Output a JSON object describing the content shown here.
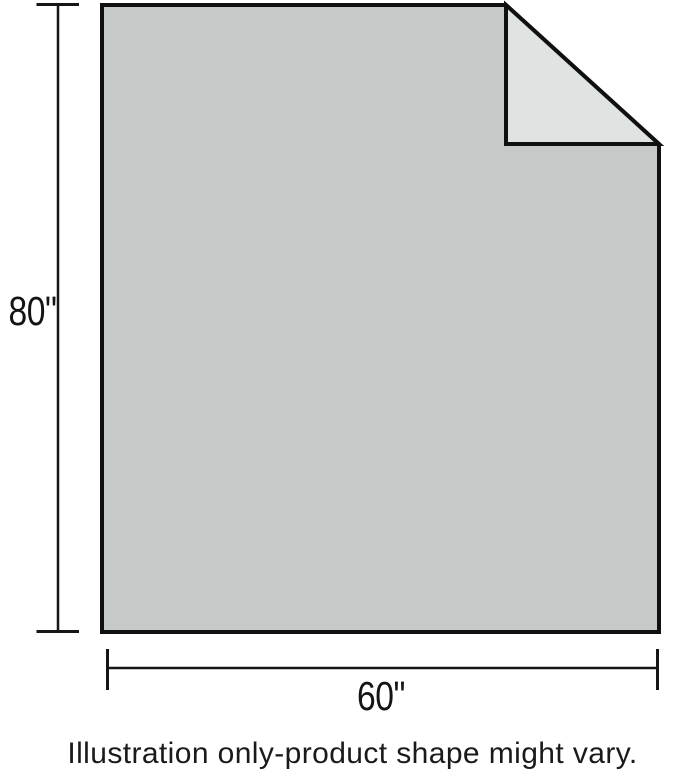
{
  "illustration": {
    "height_label": "80\"",
    "width_label": "60\"",
    "caption": "Illustration only-product shape might vary.",
    "colors": {
      "body_fill": "#c5c9c8",
      "fold_fill": "#dfe3e1",
      "outline": "#101010",
      "dimension_line": "#161616"
    }
  }
}
